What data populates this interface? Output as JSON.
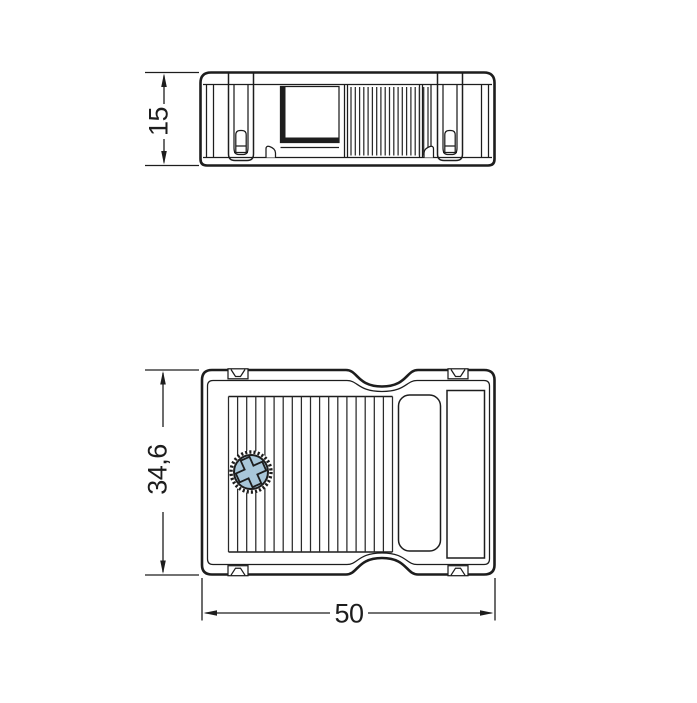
{
  "drawing": {
    "type": "technical-dimension-drawing",
    "side_view": {
      "name": "side-elevation-view",
      "height_dim": "15"
    },
    "plan_view": {
      "name": "top-plan-view",
      "height_dim": "34,6",
      "width_dim": "50"
    },
    "icons": {
      "screw": "phillips-screw"
    },
    "colors": {
      "line": "#1d1d1d",
      "screw_fill": "#a9c7d9",
      "background": "#ffffff"
    }
  }
}
